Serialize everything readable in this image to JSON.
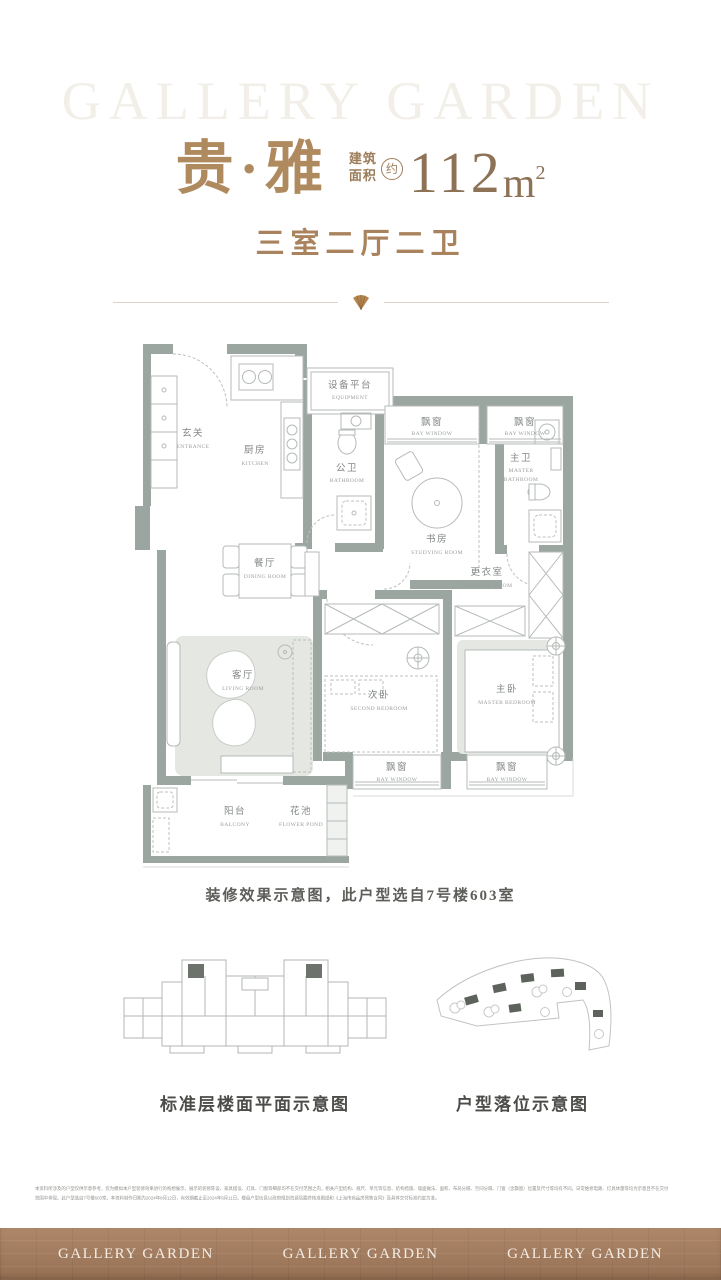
{
  "brand": {
    "watermark": "GALLERY GARDEN",
    "footer_items": [
      "GALLERY GARDEN",
      "GALLERY GARDEN",
      "GALLERY GARDEN"
    ]
  },
  "header": {
    "title": "贵·雅",
    "area_label_line1": "建筑",
    "area_label_line2": "面积",
    "approx_badge": "约",
    "area_value": "112",
    "area_unit": "m",
    "area_exponent": "2",
    "layout_text": "三室二厅二卫"
  },
  "colors": {
    "accent_gold": "#b08a5f",
    "area_brown": "#8d7256",
    "wall_gray_green": "#9ba6a1",
    "footer_bronze": "#a87e5e",
    "divider_line": "#dcd5c5",
    "gem_icon": "#b5854f"
  },
  "floorplan": {
    "caption": "装修效果示意图，此户型选自7号楼603室",
    "rooms": {
      "entrance": {
        "cn": "玄关",
        "en": "ENTRANCE"
      },
      "kitchen": {
        "cn": "厨房",
        "en": "KITCHEN"
      },
      "equipment": {
        "cn": "设备平台",
        "en": "EQUIPMENT"
      },
      "public_bath": {
        "cn": "公卫",
        "en": "BATHROOM"
      },
      "bay_window": {
        "cn": "飘窗",
        "en": "BAY WINDOW"
      },
      "study": {
        "cn": "书房",
        "en": "STUDYING ROOM"
      },
      "master_bath": {
        "cn": "主卫",
        "en_line1": "MASTER",
        "en_line2": "BATHROOM"
      },
      "dining": {
        "cn": "餐厅",
        "en": "DINING ROOM"
      },
      "dressing": {
        "cn": "更衣室",
        "en": "DRESSING ROOM"
      },
      "living": {
        "cn": "客厅",
        "en": "LIVING ROOM"
      },
      "second_bedroom": {
        "cn": "次卧",
        "en": "SECOND BEDROOM"
      },
      "master_bedroom": {
        "cn": "主卧",
        "en": "MASTER BEDROOM"
      },
      "balcony": {
        "cn": "阳台",
        "en": "BALCONY"
      },
      "flower_pond": {
        "cn": "花池",
        "en": "FLOWER POND"
      }
    }
  },
  "diagrams": {
    "left_label": "标准层楼面平面示意图",
    "right_label": "户型落位示意图"
  },
  "disclaimer": {
    "line1": "本资料所涉及的户型仅供示意参考，仅为模拟本户型装修效果进行的构想展示，展示的装修陈设、家具摆设、灯具、门窗等细部均不在交付范围之内，相关户型结构、规尺、单元等信息、结构措施、墙面做法、面积、布局分隔、空间分隔、门窗（含飘窗）位置及尺寸等均有不同，日常维修电路、灯具体量等均为示意且不在交付",
    "line2": "范围中体现。此户型选自7号楼603室。本资料制作日期为2024年8月12日，有效期截止至2024年9月11日。楼盘户型信息以政府规划资源局最终核准图纸和《上海市商品房预售合同》及具体交付标准约定为准。"
  }
}
